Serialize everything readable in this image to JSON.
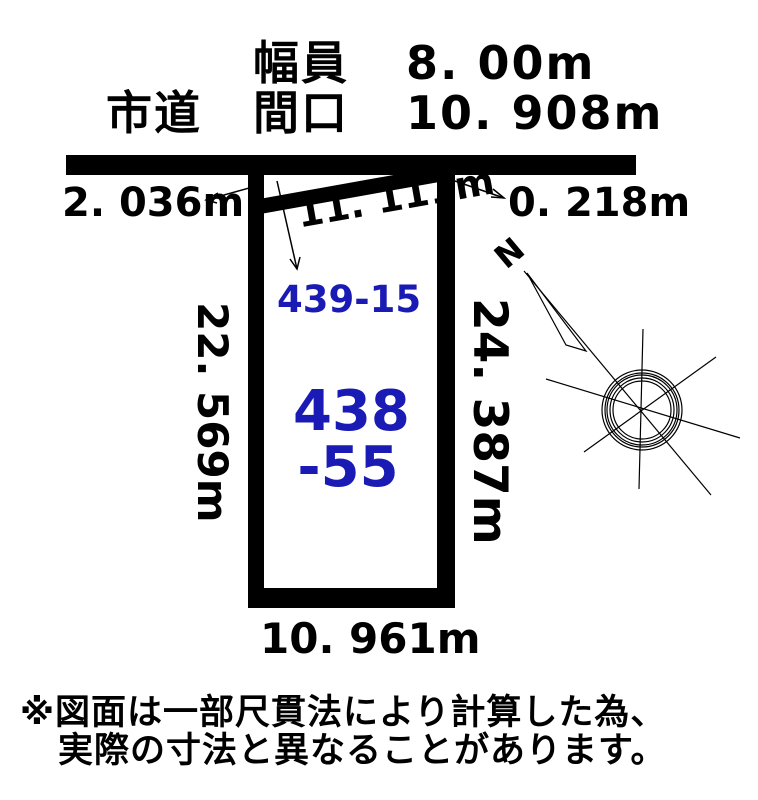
{
  "title_block": {
    "road_type": "市道",
    "width_label": "幅員",
    "width_value": "8. 00m",
    "frontage_label": "間口",
    "frontage_value": "10. 908m"
  },
  "measurements": {
    "left_offset": "2. 036m",
    "right_offset": "0. 218m",
    "top_edge": "11. 111m",
    "left_side": "22. 569m",
    "right_side": "24. 387m",
    "bottom_side": "10. 961m"
  },
  "parcels": {
    "adjacent_lot_number": "439-15",
    "main_lot_number_line1": "438",
    "main_lot_number_line2": "-55"
  },
  "compass": {
    "north_label": "N"
  },
  "disclaimer": {
    "line1": "※図面は一部尺貫法により計算した為、",
    "line2": "実際の寸法と異なることがあります。"
  },
  "colors": {
    "line_color": "#000000",
    "lot_number_color": "#1a1ab4",
    "background": "#ffffff"
  }
}
